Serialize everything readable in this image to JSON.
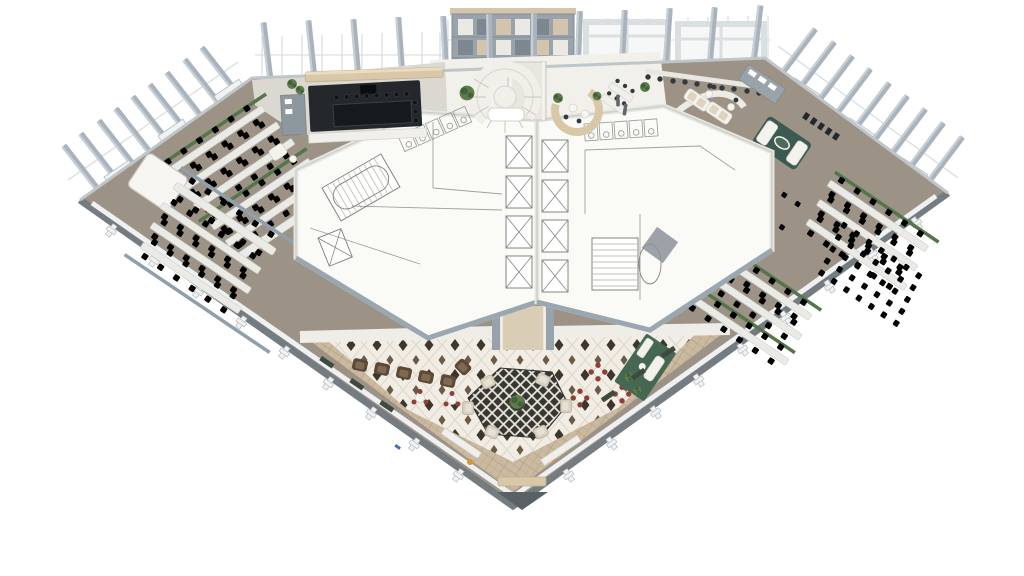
{
  "meta": {
    "title": "Isometric 3D office floor plan rendering",
    "description": "Bird's-eye axonometric render of a fan-shaped office floor: twin white service cores with elevators, stairs and WCs; perimeter curtain wall with projecting fins; open-plan desk zones; bar-cafe, feature spiral stair and shelving wall at top; diamond-tiled social plaza tapering to an entrance point at the bottom."
  },
  "palette": {
    "bg": "#ffffff",
    "fin": "#a9b3bd",
    "finLight": "#c7ced4",
    "finDark": "#8c98a2",
    "post": "#f0f2f3",
    "postEdge": "#b4bbc0",
    "edgeDark": "#747c81",
    "edgeLight": "#eef0f1",
    "facadeLine": "#bfc6ca",
    "glassLine": "#d5dadd",
    "carpet": "#9c9285",
    "carpetLight": "#aaa193",
    "coreWhite": "#fafaf7",
    "coreLine": "#84847e",
    "coreWall": "#cfcfca",
    "coreBand": "#9aa7b1",
    "tan": "#cbbaa0",
    "tanLine": "#b2a287",
    "plazaTile": "#f1ede4",
    "plazaLine": "#ddd7c9",
    "plazaDiamond": "#3e352b",
    "plazaDiamond2": "#6b5a46",
    "lattice": "#383631",
    "latticeLine": "#e9e6de",
    "loungeBeige": "#d8d1c1",
    "loungeBeigeEdge": "#b3aa97",
    "plantGreen": "#5d7c4c",
    "plantDark": "#43603a",
    "planter": "#55754a",
    "red": "#8e4038",
    "tableWhite": "#f6f5f1",
    "brown": "#5c4936",
    "brownLight": "#7f6950",
    "tealRug": "#3d5a52",
    "greenRug": "#456852",
    "sofaWhite": "#f3f2ed",
    "sofaEdge": "#d5d2c9",
    "cushion": "#ddd3be",
    "deskWhite": "#eaeae6",
    "deskEdge": "#cfcfc9",
    "chairDark": "#33383a",
    "chairOlive": "#3c453c",
    "barDark": "#24282c",
    "barTop": "#16191d",
    "barStool": "#101316",
    "counterWhite": "#f0efeb",
    "canopy": "#d9c8a8",
    "canopyEdge": "#c0ae8e",
    "canopyLight": "#e8ddc3",
    "shelf": "#9aa3ab",
    "shelfEdge": "#828c94",
    "shelfTan": "#d2c5ac",
    "shelfWhite": "#ebe9e3",
    "shelfDark": "#7d8790",
    "bridgeTan": "#d9cdb6",
    "wallGray": "#8fa0ac",
    "grayMat": "#8b9299",
    "orange": "#d9952f",
    "blue": "#3f6fbf",
    "person": "#5f666c",
    "pantry": "#9aa3aa",
    "stairTread": "#c5c2ba"
  },
  "regions": {
    "building": {
      "label": "Fan-shaped office floor plate"
    },
    "facade": {
      "label": "Curtain wall with projecting fins"
    },
    "shelfWall": {
      "label": "Double-height shelving wall"
    },
    "spiralStair": {
      "label": "Feature spiral stair and reception"
    },
    "banquette": {
      "label": "Curved banquette lounge"
    },
    "barCafe": {
      "label": "Bar / cafe counter with stools"
    },
    "leftCore": {
      "label": "West service core: elevators, stair, WCs"
    },
    "rightCore": {
      "label": "East service core: elevators, stair, WCs"
    },
    "bridge": {
      "label": "Link bridge between cores and plaza"
    },
    "officeNW": {
      "label": "North-west open-plan desks"
    },
    "officeSW": {
      "label": "South-west open-plan desks and meeting rooms"
    },
    "officeNE": {
      "label": "North-east open-plan desks"
    },
    "training": {
      "label": "Training / town-hall seating"
    },
    "officeSE": {
      "label": "South-east open-plan desks"
    },
    "execLounge": {
      "label": "Lounge with sofas and oval table"
    },
    "plaza": {
      "label": "Diamond-tiled social plaza"
    },
    "latticeLounge": {
      "label": "Central trellis lounge with planting"
    },
    "cafeTables": {
      "label": "Red bistro table sets"
    },
    "clubChairs": {
      "label": "Leather club chair row"
    },
    "greenLounge": {
      "label": "Green soft-seating nook"
    },
    "walkways": {
      "label": "Tan tiled walkways"
    },
    "entrance": {
      "label": "South point entrance"
    }
  },
  "counts": {
    "perimeter_fins_top": 12,
    "perimeter_fins_left": 9,
    "perimeter_fins_right": 9,
    "elevators_per_core": 4,
    "red_bistro_sets": 3,
    "white_table_sets": 2,
    "club_chairs": 6,
    "lattice_lounge_chairs": 6,
    "desk_rows_west": 5,
    "desk_rows_south_west": 4,
    "desk_rows_north_east": 4,
    "desk_rows_south_east": 4,
    "training_chair_rows": 5
  }
}
